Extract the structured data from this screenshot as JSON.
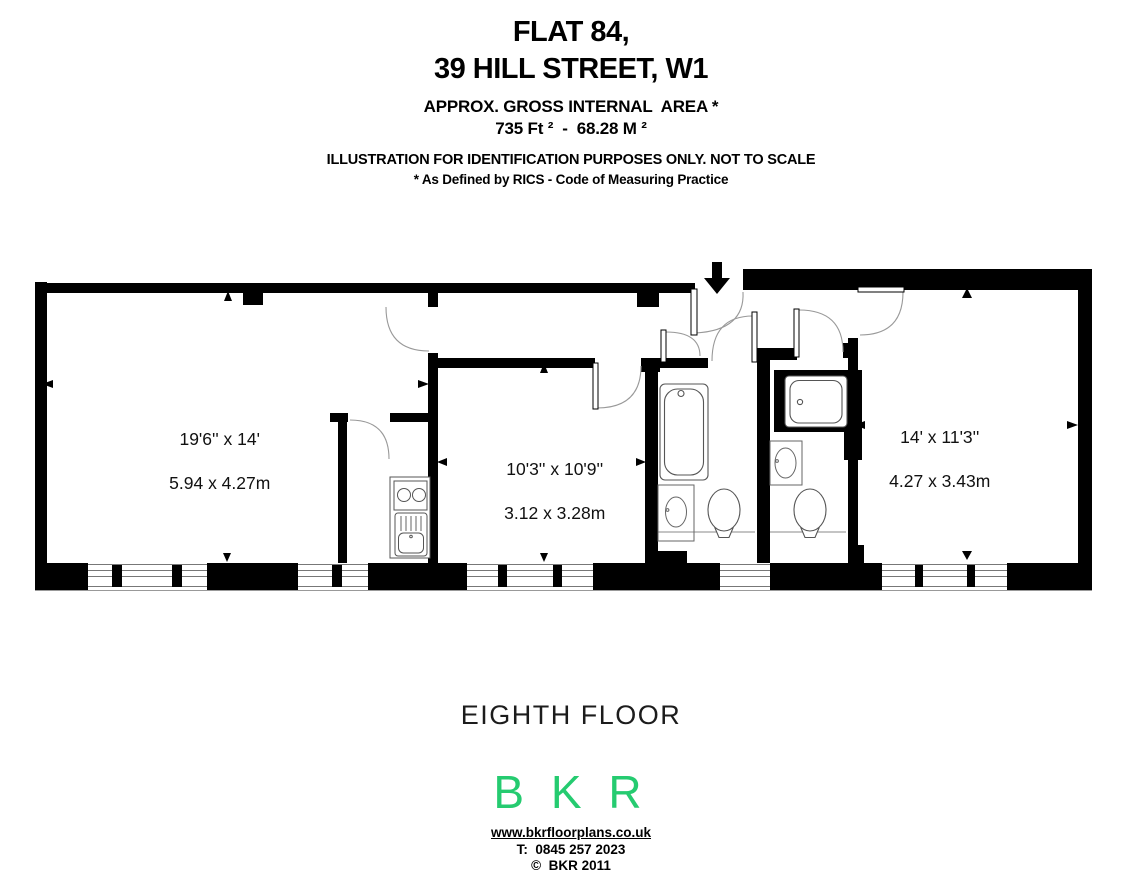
{
  "header": {
    "title_line1": "FLAT 84,",
    "title_line2": "39 HILL STREET, W1",
    "area_label": "APPROX. GROSS INTERNAL  AREA *",
    "area_value": "735 Ft ²  -  68.28 M ²",
    "disclaimer": "ILLUSTRATION FOR IDENTIFICATION PURPOSES ONLY. NOT TO SCALE",
    "rics_note": "* As Defined by RICS - Code of Measuring Practice"
  },
  "plan": {
    "rooms": [
      {
        "imperial": "19'6'' x 14'",
        "metric": "5.94 x 4.27m"
      },
      {
        "imperial": "10'3'' x 10'9''",
        "metric": "3.12 x 3.28m"
      },
      {
        "imperial": "14' x 11'3''",
        "metric": "4.27 x 3.43m"
      }
    ],
    "fixtures": [
      "bathtub",
      "toilet",
      "sink",
      "shower",
      "kitchen-hob",
      "kitchen-sink"
    ],
    "entrance_icon": "down-arrow"
  },
  "footer": {
    "floor_label": "EIGHTH FLOOR",
    "logo_text": "B K R",
    "logo_color": "#25cb70",
    "website": "www.bkrfloorplans.co.uk",
    "phone": "T:  0845 257 2023",
    "copyright": "©  BKR 2011"
  }
}
